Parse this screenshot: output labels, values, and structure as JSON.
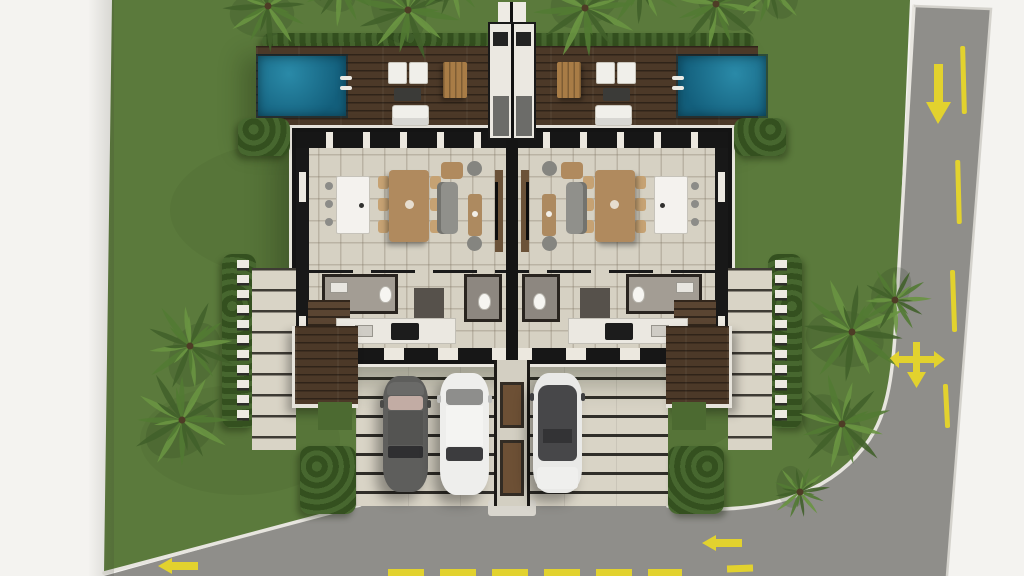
{
  "scene": {
    "kind": "3d-top-view-site-plan",
    "subject": "twin mirrored duplex villas with pools, rear deck, parking court, lawns, palm trees and an L-shaped street",
    "units_count": 2,
    "pools_count": 2,
    "parked_cars_count": 3
  },
  "road": {
    "right_lane_arrow": "down",
    "junction_marker": "three-way-arrow",
    "bottom_lane_arrow_1": "left",
    "bottom_lane_arrow_2": "left",
    "center_line_style": "yellow dashed"
  },
  "colors": {
    "paper": "#f4f3f0",
    "lawn": "#5b7a3c",
    "lawn_dark": "#4c6a31",
    "road": "#8f8e8a",
    "curb": "#e7e5df",
    "marking": "#e2d22e",
    "deck": "#4c3928",
    "pool": "#1b7694",
    "pool_deep": "#135f7c",
    "tile": "#d6d1c3",
    "wall": "#161616",
    "pavers": "#d9d4c6",
    "hedge": "#34501f",
    "hedge_light": "#47672f",
    "palm_dark": "#41612a",
    "palm": "#527a33",
    "palm_light": "#699441",
    "wood": "#a87c46",
    "stair": "#5a4532",
    "gray_floor": "#9a948c",
    "car_dark": "#5e5e5c",
    "car_white": "#eeeeec",
    "glass": "#3c3c3e",
    "sofa_gray": "#90908b",
    "tan": "#b08a5e"
  }
}
